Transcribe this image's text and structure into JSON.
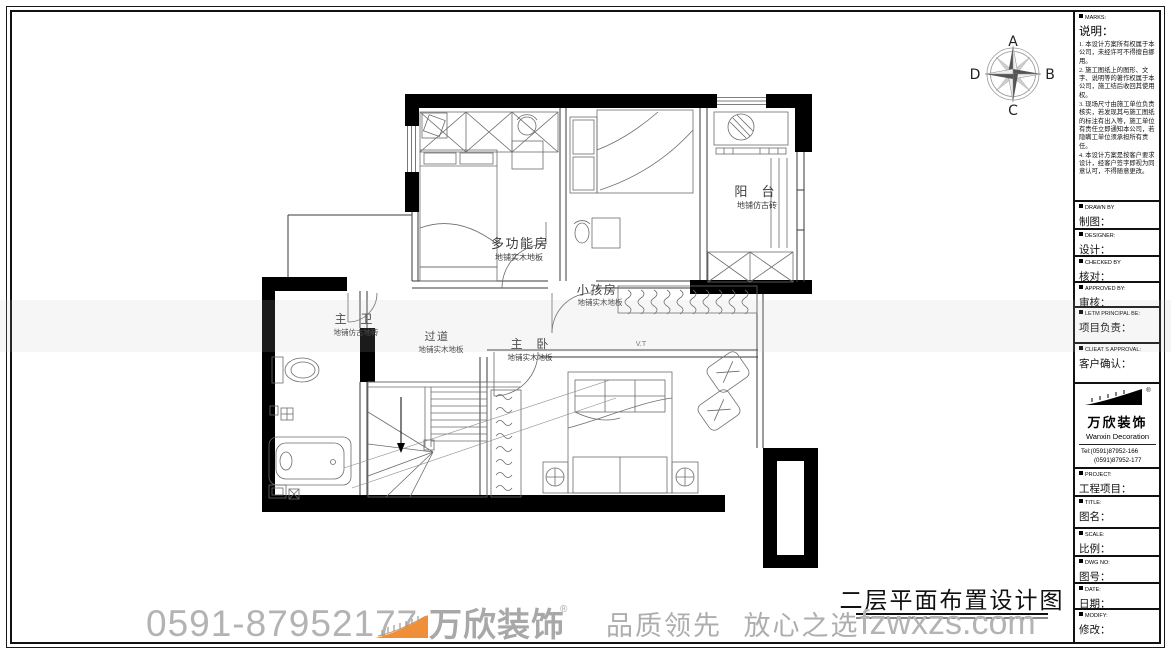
{
  "page": {
    "bottom_title": "二层平面布置设计图"
  },
  "compass": {
    "top": "A",
    "right": "B",
    "bottom": "C",
    "left": "D"
  },
  "watermark": {
    "phone": "0591-87952177",
    "brand": "万欣装饰",
    "reg_mark": "®",
    "slogan": "品质领先 放心之选",
    "website": "fzwxzs.com"
  },
  "plan": {
    "rooms": [
      {
        "name": "阳 台",
        "floor": "地铺仿古砖"
      },
      {
        "name": "多功能房",
        "floor": "地铺实木地板"
      },
      {
        "name": "小孩房",
        "floor": "地铺实木地板"
      },
      {
        "name": "主 卫",
        "floor": "地铺仿古地砖"
      },
      {
        "name": "过道",
        "floor": "地铺实木地板"
      },
      {
        "name": "主 卧",
        "floor": "地铺实木地板"
      }
    ],
    "vt_label": "V.T"
  },
  "titleblock": {
    "marks": {
      "header": "MARKS:",
      "title": "说明：",
      "notes": [
        "1. 本设计方案所有权属于本公司，未经许可不得擅自挪用。",
        "2. 施工图纸上的图形、文字、说明等的著作权属于本公司，施工结后收回其使用权。",
        "3. 现场尺寸由施工单位负责核实，若发现其与施工图纸的标注有出入等，施工单位有责任立即通知本公司，若隐瞒工单位须承担所有责任。",
        "4. 本设计方案是按客户要求设计，经客户签字即视为同意认可，不得随意更改。"
      ]
    },
    "rows": [
      {
        "header": "DRAWN BY",
        "label": "制图："
      },
      {
        "header": "DESIGNER:",
        "label": "设计："
      },
      {
        "header": "CHECKED BY",
        "label": "核对："
      },
      {
        "header": "APPROVED BY:",
        "label": "审核："
      },
      {
        "header": "LETM PRINCIPAL BE:",
        "label": "项目负责："
      },
      {
        "header": "CLIEAT S APPROVAL:",
        "label": "客户确认："
      }
    ],
    "company": {
      "brand": "万欣装饰",
      "reg": "®",
      "en": "Wanxin Decoration",
      "tel1": "Tel:(0591)87952-166",
      "tel2": "(0591)87952-177",
      "fax": "Fax:(0591)87952-199",
      "web": "Web:WWW.fzwxzs.com"
    },
    "rows2": [
      {
        "header": "PROJECT:",
        "label": "工程项目："
      },
      {
        "header": "TITLE:",
        "label": "图名："
      },
      {
        "header": "SCALE:",
        "label": "比例："
      },
      {
        "header": "DWG NO:",
        "label": "图号："
      },
      {
        "header": "DATE:",
        "label": "日期："
      },
      {
        "header": "MODIFY:",
        "label": "修改："
      }
    ]
  },
  "colors": {
    "wall_black": "#000000",
    "accent_orange": "#EF8F3A",
    "watermark_gray": "#B3B3B3"
  }
}
